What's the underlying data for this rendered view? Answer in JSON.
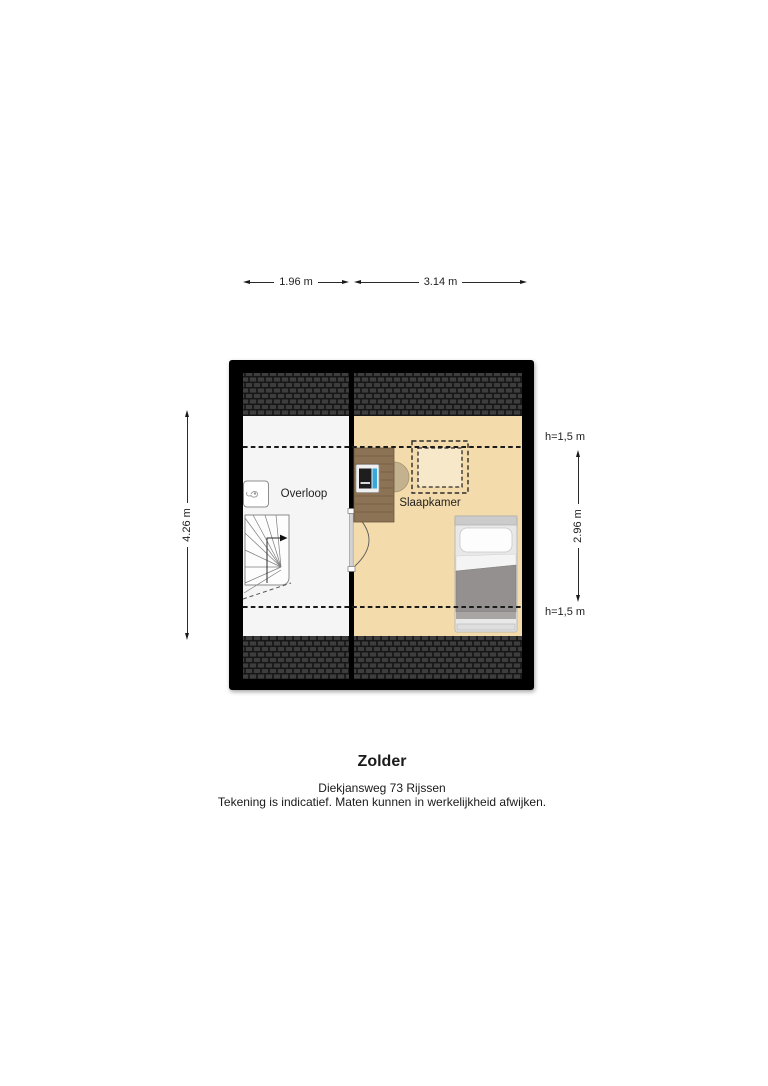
{
  "plan": {
    "floor_name": "Zolder",
    "rooms": {
      "overloop": "Overloop",
      "slaapkamer": "Slaapkamer"
    },
    "icons": {
      "staircase": "staircase-icon",
      "ventilation": "ventilation-unit-icon",
      "desk": "desk-icon",
      "chair": "chair-icon",
      "computer": "computer-icon",
      "skylight": "skylight-icon",
      "bed": "bed-icon",
      "door": "door-swing-icon",
      "roof": "roof-tiles-hatch"
    }
  },
  "dimensions": {
    "top_left": "1.96 m",
    "top_right": "3.14 m",
    "left": "4.26 m",
    "right": "2.96 m",
    "knee_top": "h=1,5 m",
    "knee_bottom": "h=1,5 m"
  },
  "caption": {
    "title": "Zolder",
    "address": "Diekjansweg 73 Rijssen",
    "disclaimer": "Tekening is indicatief. Maten kunnen in werkelijkheid afwijken."
  },
  "colors": {
    "wall": "#000000",
    "floor_left": "#f5f5f5",
    "floor_right": "#f4dbab",
    "skylight_inner": "#f8e8ca",
    "roof_tile": "#3e3e3e",
    "wood": "#8d7355",
    "duvet": "#949090",
    "duvet_fold": "#a9a5a2",
    "screen_blue": "#38a8dc"
  }
}
